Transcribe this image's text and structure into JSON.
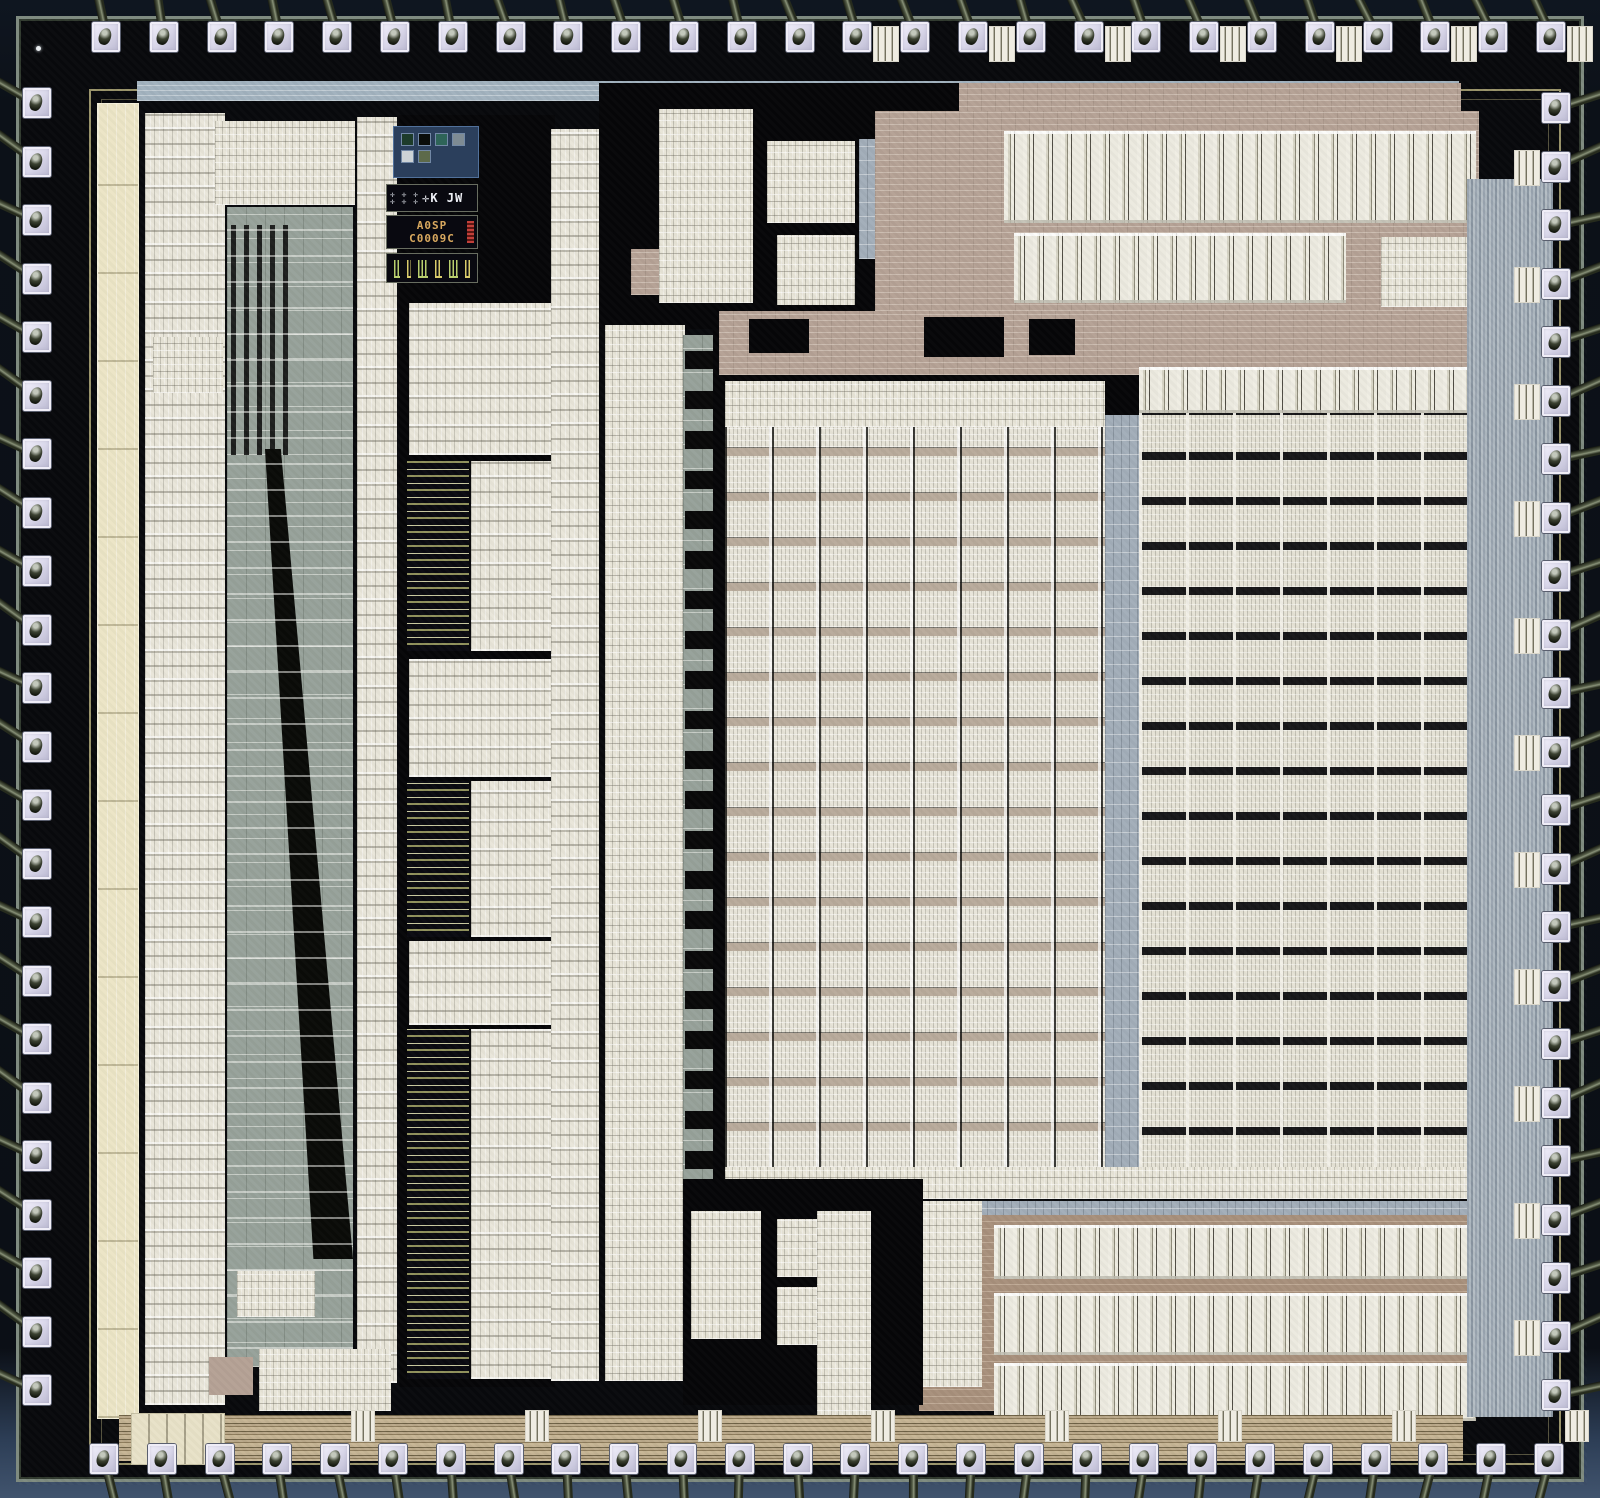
{
  "meta": {
    "subject": "integrated circuit die photograph",
    "style": "microscope die shot with bond wires"
  },
  "colors": {
    "package": "#0c1118",
    "package_bottom": "#41546e",
    "die_black": "#08090c",
    "street_green": "#7f8b80",
    "seal_khaki": "#b4ad7d",
    "pad_lavender": "#dcdaec",
    "wire_olive": "#565e48",
    "cell_white": "#e9e6da",
    "cream": "#ece5c6",
    "channel_gray": "#97a29a",
    "channel_blue": "#a3aeb9",
    "mauve": "#b5a295",
    "tan": "#a8907c",
    "bus_khaki": "#c7b695",
    "logo_blue": "#2b3f5c",
    "marking_orange": "#d9a95f",
    "vernier_green": "#b9cf6e",
    "vernier_yellow": "#d9cb6b"
  },
  "markings": {
    "crosses": "✛ ✛ ✛\n✛ ✛ ✛",
    "logo_text": "✛K JW",
    "line1": "A0SP",
    "line2": "C0009C"
  },
  "logo_swatches": [
    "#1d3b2a",
    "#0a0d0a",
    "#2e6458",
    "#7e8b93",
    "#cdd3d6",
    "#5d6a4a"
  ],
  "verniers": [
    {
      "color": "#b9cf6e",
      "w": 8
    },
    {
      "color": "#d9cb6b",
      "w": 5
    },
    {
      "color": "#b9cf6e",
      "w": 14
    },
    {
      "color": "#d9cb6b",
      "w": 10
    },
    {
      "color": "#b9cf6e",
      "w": 12
    },
    {
      "color": "#d9cb6b",
      "w": 7
    }
  ],
  "pads": {
    "top": {
      "count": 26,
      "c0": 106,
      "pitch": 57.8,
      "edge": 22
    },
    "bottom": {
      "count": 26,
      "c0": 104,
      "pitch": 57.8,
      "edge": 1444
    },
    "left": {
      "count": 23,
      "c0": 103,
      "pitch": 58.5,
      "edge": 23
    },
    "right": {
      "count": 23,
      "c0": 108,
      "pitch": 58.5,
      "edge": 1542
    }
  },
  "regions": [
    {
      "name": "seal-ring-outer",
      "cls": "seal",
      "x": 70,
      "y": 70,
      "w": 1472,
      "h": 1376
    },
    {
      "name": "seal-ring-inner",
      "cls": "seal2",
      "x": 82,
      "y": 80,
      "w": 1448,
      "h": 1356
    },
    {
      "name": "top-routing-band",
      "cls": "blue-band",
      "x": 118,
      "y": 62,
      "w": 1322,
      "h": 20
    },
    {
      "name": "topright-mauve-band",
      "cls": "mauve-tex",
      "x": 850,
      "y": 64,
      "w": 592,
      "h": 42
    },
    {
      "name": "left-cream-strip",
      "cls": "cream",
      "x": 78,
      "y": 84,
      "w": 42,
      "h": 1316
    },
    {
      "name": "left-cell-column",
      "cls": "cells",
      "x": 126,
      "y": 94,
      "w": 80,
      "h": 1292
    },
    {
      "name": "topleft-logic-cluster",
      "cls": "cells-fine",
      "x": 196,
      "y": 102,
      "w": 140,
      "h": 84
    },
    {
      "name": "left-routing-channel",
      "cls": "channel-gray",
      "x": 208,
      "y": 188,
      "w": 126,
      "h": 1160
    },
    {
      "name": "left-channel-stripes",
      "cls": "vstripes",
      "x": 212,
      "y": 206,
      "w": 58,
      "h": 230
    },
    {
      "name": "left-channel-wedge",
      "cls": "wedge",
      "x": 246,
      "y": 430,
      "w": 88,
      "h": 810
    },
    {
      "name": "left-channel-fanlines",
      "cls": "hlines",
      "x": 208,
      "y": 210,
      "w": 126,
      "h": 1120
    },
    {
      "name": "small-logic-block-a",
      "cls": "cells-fine",
      "x": 134,
      "y": 318,
      "w": 70,
      "h": 56
    },
    {
      "name": "col2-cell-column",
      "cls": "cells",
      "x": 338,
      "y": 98,
      "w": 40,
      "h": 1266
    },
    {
      "name": "col2-black-underlay",
      "cls": "black",
      "x": 380,
      "y": 96,
      "w": 156,
      "h": 1272
    },
    {
      "name": "col2-datapath-1",
      "cls": "cells",
      "x": 390,
      "y": 284,
      "w": 142,
      "h": 152
    },
    {
      "name": "col2-rom-1",
      "cls": "rom",
      "x": 388,
      "y": 442,
      "w": 62,
      "h": 190
    },
    {
      "name": "col2-cells-1",
      "cls": "cells",
      "x": 452,
      "y": 442,
      "w": 80,
      "h": 190
    },
    {
      "name": "col2-datapath-2",
      "cls": "cells",
      "x": 390,
      "y": 640,
      "w": 142,
      "h": 118
    },
    {
      "name": "col2-rom-2",
      "cls": "rom",
      "x": 388,
      "y": 762,
      "w": 62,
      "h": 156
    },
    {
      "name": "col2-cells-2",
      "cls": "cells",
      "x": 452,
      "y": 762,
      "w": 80,
      "h": 156
    },
    {
      "name": "col2-datapath-3",
      "cls": "cells",
      "x": 390,
      "y": 922,
      "w": 142,
      "h": 84
    },
    {
      "name": "col2-rom-3",
      "cls": "rom",
      "x": 388,
      "y": 1010,
      "w": 62,
      "h": 350
    },
    {
      "name": "col2-cells-3",
      "cls": "cells",
      "x": 452,
      "y": 1010,
      "w": 80,
      "h": 350
    },
    {
      "name": "col3-cell-column",
      "cls": "cells",
      "x": 532,
      "y": 110,
      "w": 48,
      "h": 1252
    },
    {
      "name": "topmid-black-underlay",
      "cls": "black",
      "x": 580,
      "y": 64,
      "w": 360,
      "h": 246
    },
    {
      "name": "topmid-mauve-patch",
      "cls": "mauve-tex",
      "x": 612,
      "y": 230,
      "w": 120,
      "h": 46
    },
    {
      "name": "topmid-blue-patch",
      "cls": "channel-blue",
      "x": 840,
      "y": 120,
      "w": 60,
      "h": 120
    },
    {
      "name": "topmid-logic-a",
      "cls": "cells-fine",
      "x": 640,
      "y": 90,
      "w": 94,
      "h": 194
    },
    {
      "name": "topmid-logic-b",
      "cls": "cells-fine",
      "x": 748,
      "y": 122,
      "w": 88,
      "h": 82
    },
    {
      "name": "topmid-logic-c",
      "cls": "cells-fine",
      "x": 758,
      "y": 216,
      "w": 78,
      "h": 72
    },
    {
      "name": "mid-cell-strip",
      "cls": "cells-fine",
      "x": 586,
      "y": 306,
      "w": 80,
      "h": 1056
    },
    {
      "name": "mid-strip-channel",
      "cls": "channel-gray",
      "x": 664,
      "y": 316,
      "w": 30,
      "h": 1046
    },
    {
      "name": "mid-strip-dashes",
      "cls": "dash-col",
      "x": 666,
      "y": 330,
      "w": 28,
      "h": 1020
    },
    {
      "name": "core-black-underlay",
      "cls": "black",
      "x": 694,
      "y": 286,
      "w": 766,
      "h": 884
    },
    {
      "name": "topright-mauve-field",
      "cls": "mauve-tex",
      "x": 856,
      "y": 92,
      "w": 604,
      "h": 200
    },
    {
      "name": "topright-array-1",
      "cls": "cells-v",
      "x": 985,
      "y": 112,
      "w": 472,
      "h": 92
    },
    {
      "name": "topright-array-2",
      "cls": "cells-v",
      "x": 995,
      "y": 214,
      "w": 332,
      "h": 70
    },
    {
      "name": "topright-block",
      "cls": "cells-fine",
      "x": 1362,
      "y": 218,
      "w": 96,
      "h": 70
    },
    {
      "name": "core-mauve-routing",
      "cls": "mauve-tex",
      "x": 700,
      "y": 292,
      "w": 758,
      "h": 64
    },
    {
      "name": "routing-black-1",
      "cls": "black",
      "x": 730,
      "y": 300,
      "w": 60,
      "h": 34
    },
    {
      "name": "routing-black-2",
      "cls": "black",
      "x": 905,
      "y": 298,
      "w": 80,
      "h": 40
    },
    {
      "name": "routing-black-3",
      "cls": "black",
      "x": 1010,
      "y": 300,
      "w": 46,
      "h": 36
    },
    {
      "name": "rightarray-header-row",
      "cls": "cells-v",
      "x": 1120,
      "y": 348,
      "w": 336,
      "h": 46
    },
    {
      "name": "leftarray-header-row",
      "cls": "cells-fine",
      "x": 706,
      "y": 362,
      "w": 380,
      "h": 46
    },
    {
      "name": "main-array-left",
      "cls": "array-left",
      "x": 706,
      "y": 408,
      "w": 380,
      "h": 740
    },
    {
      "name": "array-divider-column",
      "cls": "channel-blue",
      "x": 1086,
      "y": 396,
      "w": 34,
      "h": 754
    },
    {
      "name": "main-array-right",
      "cls": "array-right",
      "x": 1120,
      "y": 394,
      "w": 336,
      "h": 756
    },
    {
      "name": "array-footer-row",
      "cls": "cells-fine",
      "x": 706,
      "y": 1148,
      "w": 752,
      "h": 32
    },
    {
      "name": "below-array-channel",
      "cls": "channel-blue",
      "x": 664,
      "y": 1182,
      "w": 796,
      "h": 36
    },
    {
      "name": "bottomright-tan-field",
      "cls": "tan-tex",
      "x": 900,
      "y": 1196,
      "w": 560,
      "h": 196
    },
    {
      "name": "bottomright-band-1",
      "cls": "cells-v",
      "x": 975,
      "y": 1206,
      "w": 482,
      "h": 54
    },
    {
      "name": "bottomright-band-2",
      "cls": "cells-v",
      "x": 975,
      "y": 1274,
      "w": 482,
      "h": 62
    },
    {
      "name": "bottomright-band-3",
      "cls": "cells-v",
      "x": 975,
      "y": 1344,
      "w": 482,
      "h": 58
    },
    {
      "name": "bottomright-side-block",
      "cls": "cells-fine",
      "x": 903,
      "y": 1182,
      "w": 60,
      "h": 186
    },
    {
      "name": "bottommid-black",
      "cls": "black",
      "x": 664,
      "y": 1160,
      "w": 240,
      "h": 226
    },
    {
      "name": "bottommid-logic-a",
      "cls": "cells-fine",
      "x": 672,
      "y": 1192,
      "w": 70,
      "h": 128
    },
    {
      "name": "bottommid-logic-b",
      "cls": "cells-fine",
      "x": 758,
      "y": 1200,
      "w": 88,
      "h": 58
    },
    {
      "name": "bottommid-logic-c",
      "cls": "cells-fine",
      "x": 758,
      "y": 1268,
      "w": 88,
      "h": 58
    },
    {
      "name": "bottommid-column",
      "cls": "cells-fine",
      "x": 798,
      "y": 1192,
      "w": 54,
      "h": 214
    },
    {
      "name": "bottom-bus",
      "cls": "bus-h",
      "x": 100,
      "y": 1396,
      "w": 1344,
      "h": 46
    },
    {
      "name": "bottomleft-pale-block",
      "cls": "pale-block",
      "x": 112,
      "y": 1394,
      "w": 94,
      "h": 52
    },
    {
      "name": "bottomleft-cluster",
      "cls": "cells-fine",
      "x": 240,
      "y": 1330,
      "w": 132,
      "h": 62
    },
    {
      "name": "bottomleft-mauve-patch",
      "cls": "mauve",
      "x": 190,
      "y": 1338,
      "w": 44,
      "h": 38
    },
    {
      "name": "bottomleft-block-b",
      "cls": "cells-fine",
      "x": 218,
      "y": 1252,
      "w": 78,
      "h": 46
    },
    {
      "name": "right-bus-band",
      "cls": "bus-v",
      "x": 1448,
      "y": 160,
      "w": 86,
      "h": 1238
    },
    {
      "name": "die-grain-overlay",
      "cls": "grain",
      "x": 0,
      "y": 0,
      "w": 1568,
      "h": 1466
    }
  ]
}
